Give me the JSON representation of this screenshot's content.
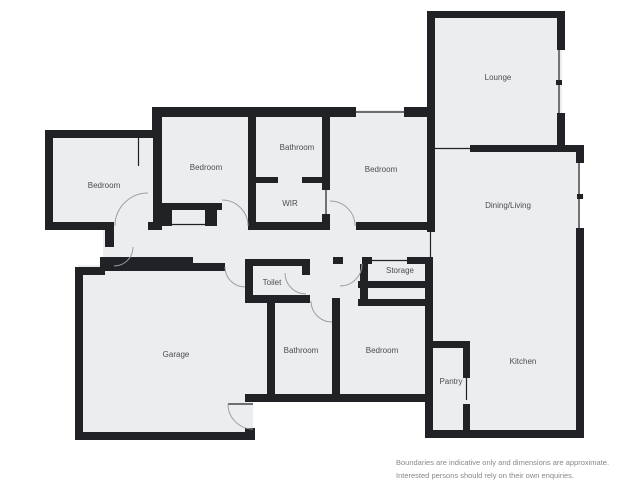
{
  "plan": {
    "title_hint": "floor-plan",
    "rooms": [
      {
        "label": "Bedroom",
        "x": 104,
        "y": 188
      },
      {
        "label": "Bedroom",
        "x": 206,
        "y": 170
      },
      {
        "label": "Bathroom",
        "x": 297,
        "y": 150
      },
      {
        "label": "WIR",
        "x": 290,
        "y": 206
      },
      {
        "label": "Bedroom",
        "x": 381,
        "y": 172
      },
      {
        "label": "Lounge",
        "x": 498,
        "y": 80
      },
      {
        "label": "Dining/Living",
        "x": 508,
        "y": 208
      },
      {
        "label": "Storage",
        "x": 400,
        "y": 273
      },
      {
        "label": "Toilet",
        "x": 272,
        "y": 285
      },
      {
        "label": "Garage",
        "x": 176,
        "y": 357
      },
      {
        "label": "Bathroom",
        "x": 301,
        "y": 353
      },
      {
        "label": "Bedroom",
        "x": 382,
        "y": 353
      },
      {
        "label": "Pantry",
        "x": 451,
        "y": 384
      },
      {
        "label": "Kitchen",
        "x": 523,
        "y": 364
      }
    ]
  },
  "disclaimer": {
    "line1": "Boundaries are indicative only and dimensions are approximate.",
    "line2": "Interested persons should rely on their own enquiries."
  },
  "colors": {
    "wall": "#212225",
    "floor": "#ECEDEF",
    "arc": "#9aa0a4",
    "label": "#4a4d4f",
    "disclaimer": "#85888a",
    "background": "#ffffff"
  }
}
